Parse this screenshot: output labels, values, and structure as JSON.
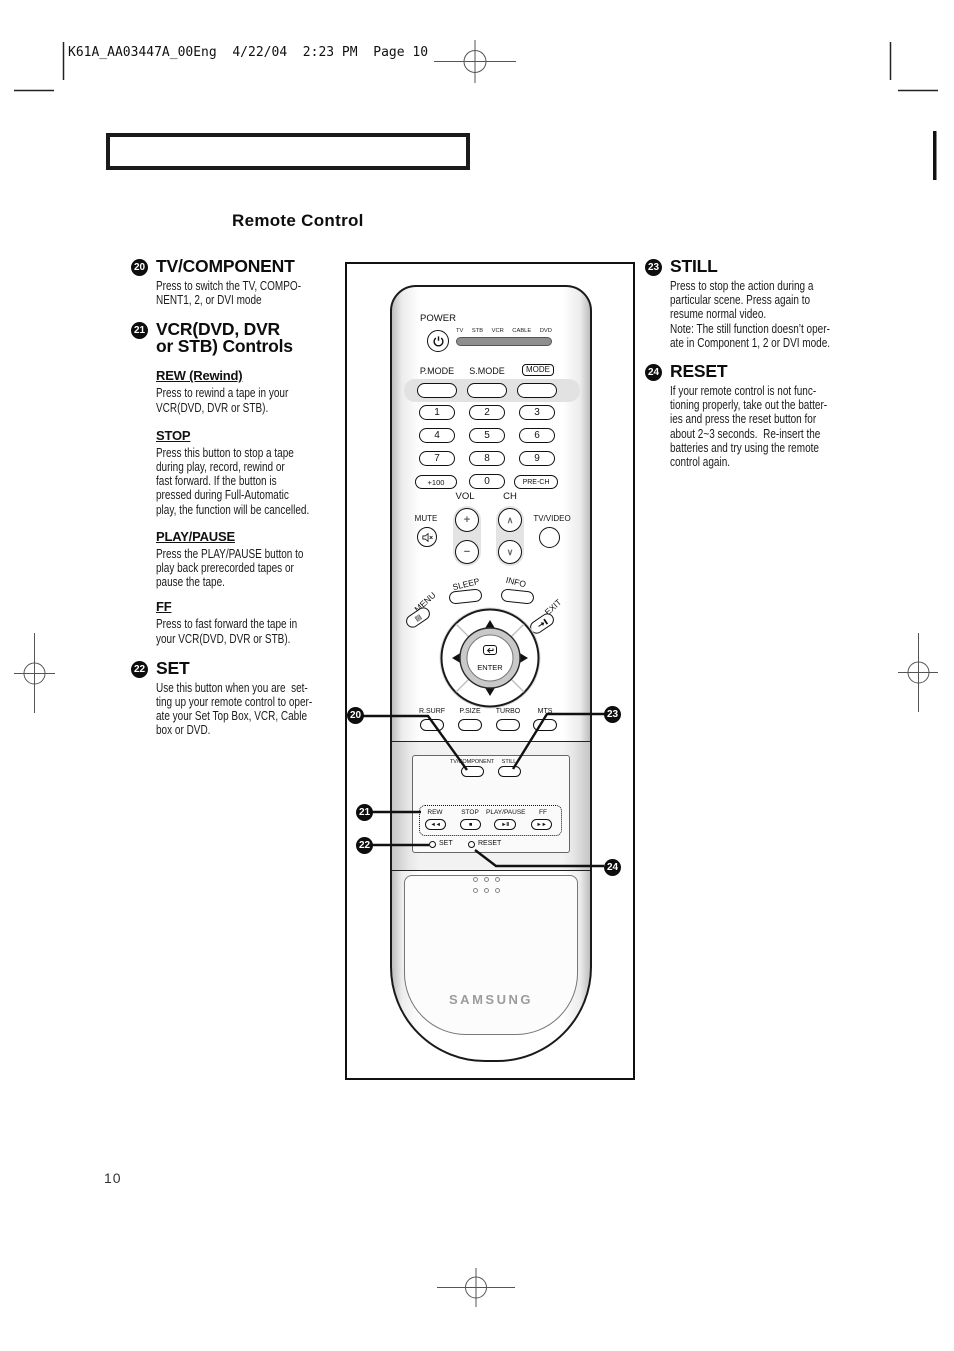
{
  "page": {
    "header_text": "K61A_AA03447A_00Eng  4/22/04  2:23 PM  Page 10",
    "section_heading": "Remote Control",
    "page_number": "10"
  },
  "left_column": {
    "item20": {
      "num": "20",
      "title": "TV/COMPONENT",
      "body": "Press to switch the TV, COMPO-\nNENT1, 2, or DVI mode"
    },
    "item21": {
      "num": "21",
      "title": "VCR(DVD, DVR\nor STB) Controls"
    },
    "rew": {
      "label": "REW (Rewind)",
      "body": "Press to rewind a tape in your\nVCR(DVD, DVR or STB)."
    },
    "stop": {
      "label": "STOP",
      "body": "Press this button to stop a tape\nduring play, record, rewind or\nfast forward. If the button is\npressed during Full-Automatic\nplay, the function will be cancelled."
    },
    "playpause": {
      "label": "PLAY/PAUSE",
      "body": "Press the PLAY/PAUSE button to\nplay back prerecorded tapes or\npause the tape."
    },
    "ff": {
      "label": "FF",
      "body": "Press to fast forward the tape in\nyour VCR(DVD, DVR or STB)."
    },
    "item22": {
      "num": "22",
      "title": "SET",
      "body": "Use this button when you are  set-\nting up your remote control to oper-\nate your Set Top Box, VCR, Cable\nbox or DVD."
    }
  },
  "right_column": {
    "item23": {
      "num": "23",
      "title": "STILL",
      "body": "Press to stop the action during a\nparticular scene. Press again to\nresume normal video.\nNote: The still function doesn’t oper-\nate in Component 1, 2 or DVI mode."
    },
    "item24": {
      "num": "24",
      "title": "RESET",
      "body": "If your remote control is not func-\ntioning properly, take out the batter-\nies and press the reset button for\nabout 2~3 seconds.  Re-insert the\nbatteries and try using the remote\ncontrol again."
    }
  },
  "remote": {
    "power_label": "POWER",
    "device_labels": [
      "TV",
      "STB",
      "VCR",
      "CABLE",
      "DVD"
    ],
    "pmode_label": "P.MODE",
    "smode_label": "S.MODE",
    "mode_label": "MODE",
    "digits": [
      "1",
      "2",
      "3",
      "4",
      "5",
      "6",
      "7",
      "8",
      "9"
    ],
    "plus100_label": "+100",
    "zero_label": "0",
    "prech_label": "PRE-CH",
    "vol_label": "VOL",
    "ch_label": "CH",
    "mute_label": "MUTE",
    "tvvideo_label": "TV/VIDEO",
    "vol_up": "+",
    "vol_down": "−",
    "ch_up": "∧",
    "ch_down": "∨",
    "sleep_label": "SLEEP",
    "info_label": "INFO",
    "menu_label": "MENU",
    "exit_label": "EXIT",
    "menu_icon": "▤",
    "enter_label": "ENTER",
    "rsurf_label": "R.SURF",
    "psize_label": "P.SIZE",
    "turbo_label": "TURBO",
    "mts_label": "MTS",
    "tvcomponent_label": "TV/COMPONENT",
    "still_label": "STILL",
    "rew_label": "REW",
    "stop_label": "STOP",
    "playpause_label": "PLAY/PAUSE",
    "ff_label": "FF",
    "rew_icon": "◄◄",
    "stop_icon": "■",
    "playpause_icon": "►II",
    "ff_icon": "►►",
    "set_label": "SET",
    "reset_label": "RESET",
    "brand": "SAMSUNG"
  },
  "callouts": {
    "c20": "20",
    "c21": "21",
    "c22": "22",
    "c23": "23",
    "c24": "24"
  },
  "colors": {
    "ink": "#111111",
    "badge": "#0d0d0d",
    "brand_gray": "#9c9c9c",
    "strip_gray": "#8f8f8f"
  }
}
